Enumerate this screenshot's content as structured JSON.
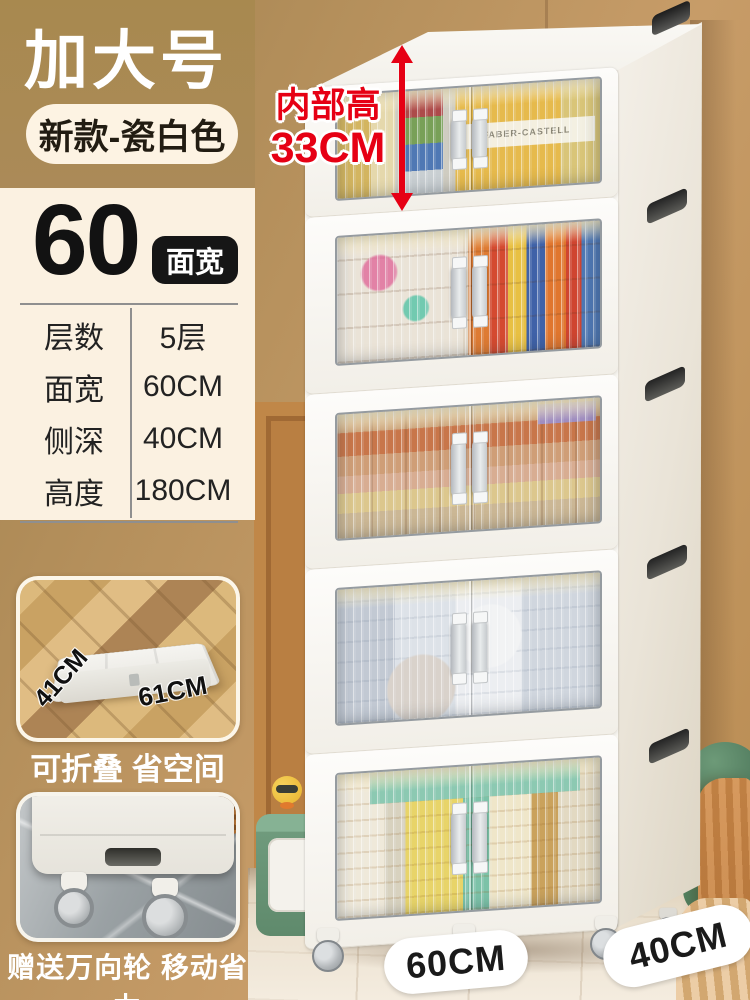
{
  "colors": {
    "accent_red": "#e60014",
    "wall_tan": "#ab8956",
    "wall_wood_slats": "#ae7340",
    "panel_cream": "#fbf1e1",
    "badge_dark": "#161616",
    "cabinet_white": "#f9f7f2",
    "caption_white": "#ffffff"
  },
  "header": {
    "size_badge": "加大号",
    "variant_badge": "新款-瓷白色"
  },
  "spec_panel": {
    "width_number": "60",
    "width_badge": "面宽",
    "rows": [
      {
        "label": "层数",
        "value": "5层"
      },
      {
        "label": "面宽",
        "value": "60CM"
      },
      {
        "label": "侧深",
        "value": "40CM"
      },
      {
        "label": "高度",
        "value": "180CM"
      }
    ]
  },
  "annotation": {
    "line1": "内部高",
    "line2": "33CM"
  },
  "fold_card": {
    "depth_label": "41CM",
    "width_label": "61CM",
    "caption": "可折叠 省空间"
  },
  "wheel_card": {
    "caption": "赠送万向轮 移动省力"
  },
  "floor_pills": {
    "width": "60CM",
    "depth": "40CM"
  },
  "cabinet": {
    "tier_count": "5",
    "tier1_box_text": "FABER-CASTELL"
  }
}
